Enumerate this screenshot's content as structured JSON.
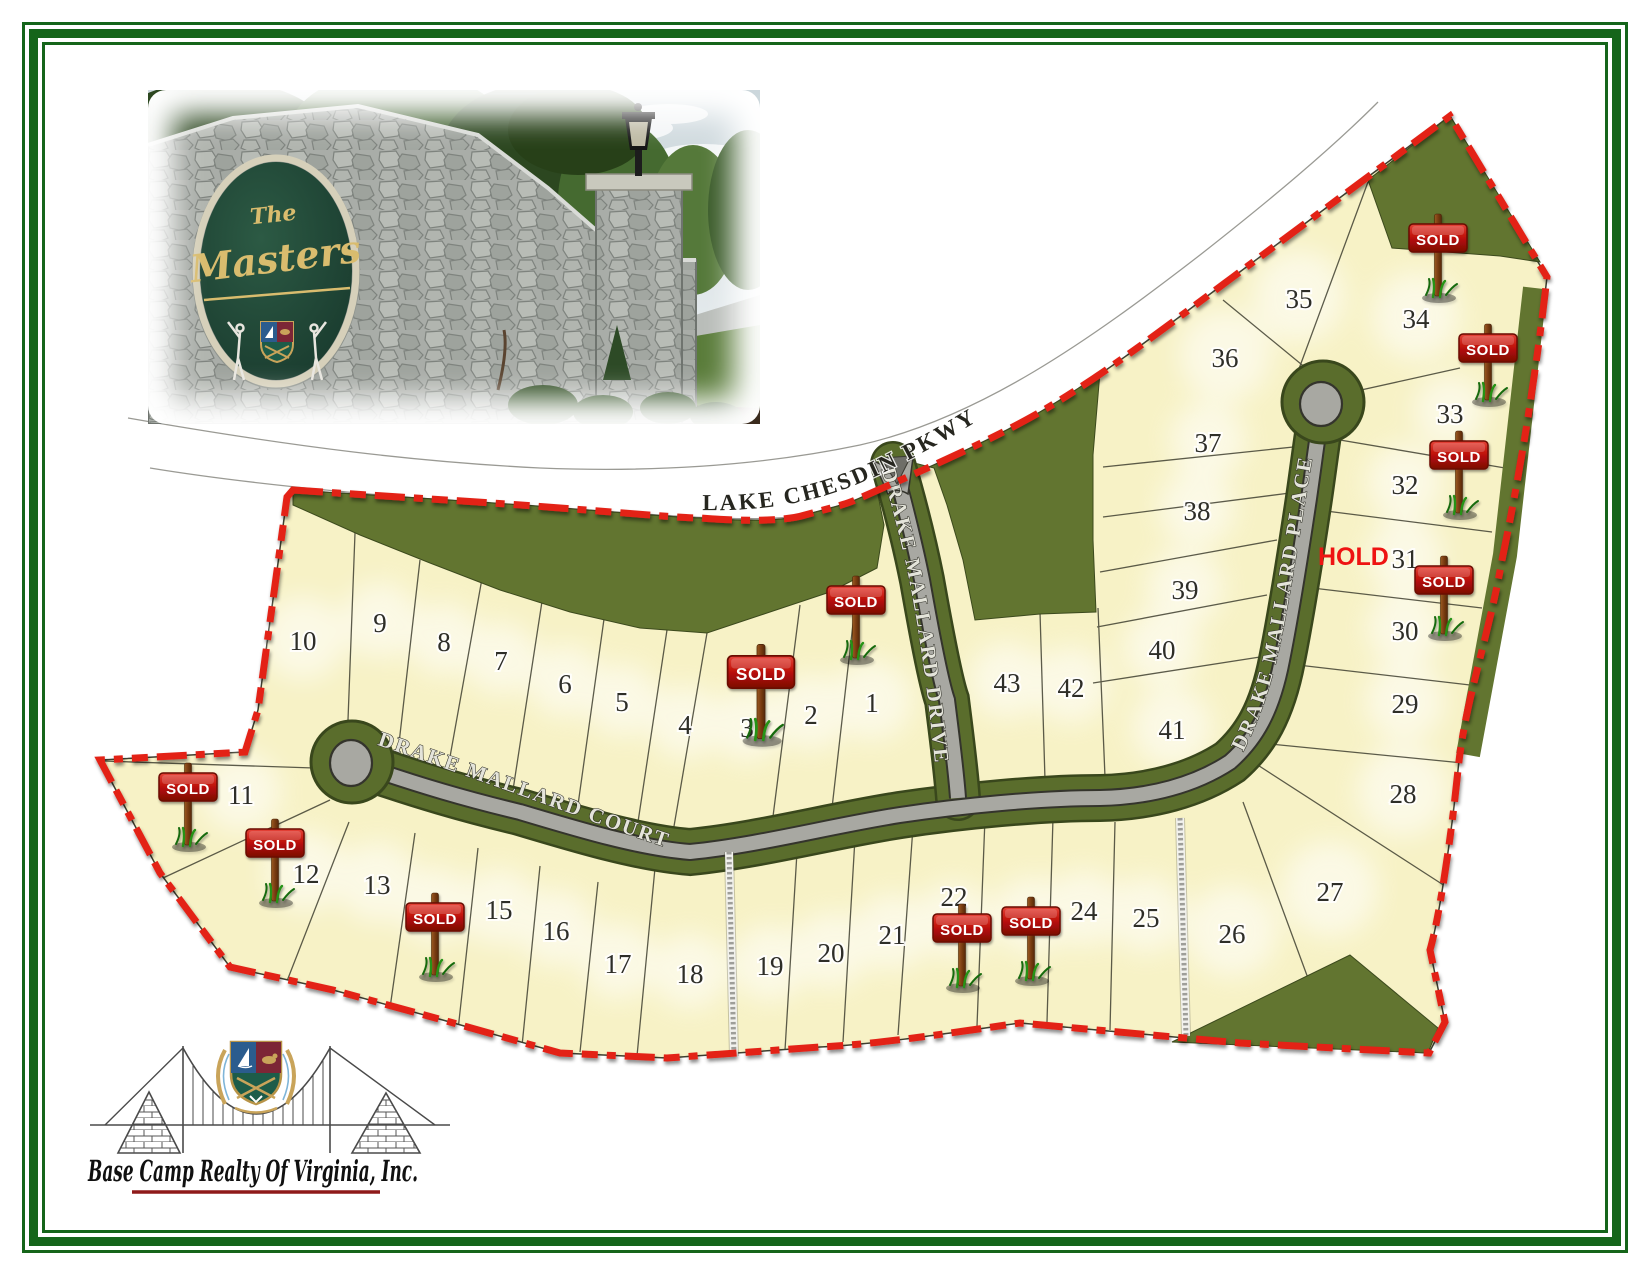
{
  "photo": {
    "entrance_sign_top": "The",
    "entrance_sign_main": "Masters"
  },
  "map": {
    "sold_label": "SOLD",
    "hold_label": "HOLD",
    "roads": {
      "lake_chesdin": "LAKE CHESDIN PKWY",
      "court": "DRAKE MALLARD COURT",
      "drive": "DRAKE MALLARD DRIVE",
      "place": "DRAKE MALLARD PLACE"
    },
    "lots": [
      "1",
      "2",
      "3",
      "4",
      "5",
      "6",
      "7",
      "8",
      "9",
      "10",
      "11",
      "12",
      "13",
      "15",
      "16",
      "17",
      "18",
      "19",
      "20",
      "21",
      "22",
      "24",
      "25",
      "26",
      "27",
      "28",
      "29",
      "30",
      "31",
      "32",
      "33",
      "34",
      "35",
      "36",
      "37",
      "38",
      "39",
      "40",
      "41",
      "42",
      "43"
    ],
    "sold_sign_placements": [
      "lot-2",
      "lot-3",
      "lot-11",
      "lot-12",
      "lot-14",
      "lot-22",
      "lot-23",
      "lot-31",
      "lot-32",
      "lot-33",
      "lot-34"
    ]
  },
  "branding": {
    "company_name": "Base Camp Realty Of Virginia, Inc."
  },
  "colors": {
    "boundary_red": "#e32119",
    "lot_fill": "#f7f2c6",
    "common_green": "#627530",
    "pavement_gray": "#a8a8a2",
    "frame_green": "#15651a",
    "sign_red": "#b01108",
    "hold_red": "#ee1312",
    "gold": "#d4b96a"
  }
}
